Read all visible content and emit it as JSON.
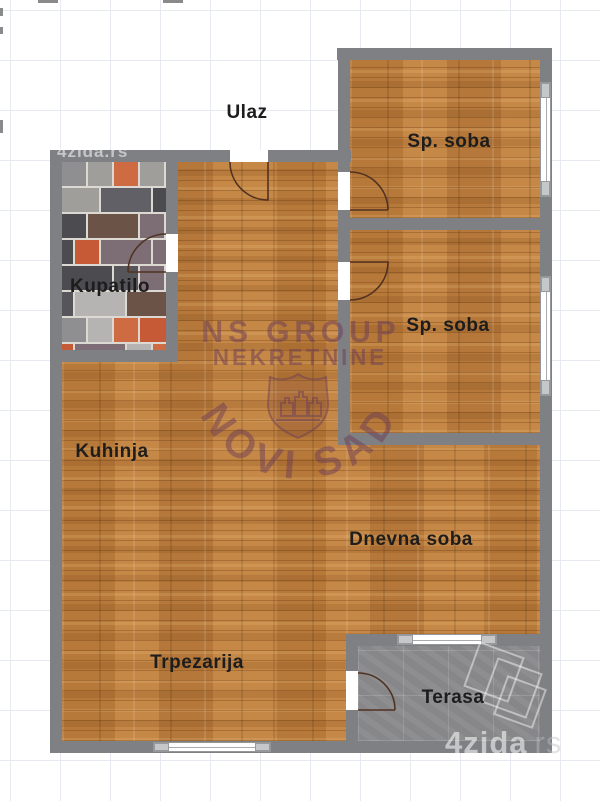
{
  "rooms": {
    "ulaz": {
      "label": "Ulaz"
    },
    "sp_soba_1": {
      "label": "Sp. soba"
    },
    "sp_soba_2": {
      "label": "Sp. soba"
    },
    "kupatilo": {
      "label": "Kupatilo"
    },
    "kuhinja": {
      "label": "Kuhinja"
    },
    "dnevna_soba": {
      "label": "Dnevna soba"
    },
    "trpezarija": {
      "label": "Trpezarija"
    },
    "terasa": {
      "label": "Terasa"
    }
  },
  "watermarks": {
    "agency": {
      "line1": "NS GROUP",
      "line2": "NEKRETNINE",
      "arc": "NOVI SAD"
    },
    "site_small": "4zida.rs",
    "site_large": "4zida",
    "site_large_suffix": "rs"
  },
  "colors": {
    "wall": "#7e8083",
    "wood_base": "#c0813f",
    "terrace_floor": "#8e8e90",
    "label_text": "#1d1d1d",
    "agency_watermark": "#6e3e56",
    "door_arc": "#503220",
    "grid_line": "#e7e9f0",
    "tile_grout": "#dcd8d2",
    "tile_palette": [
      "#4b4b50",
      "#606066",
      "#8f8f91",
      "#b5b4b2",
      "#c65a36",
      "#cf6b42",
      "#6b5347",
      "#55555a",
      "#7d6e75",
      "#a09e9b"
    ]
  }
}
